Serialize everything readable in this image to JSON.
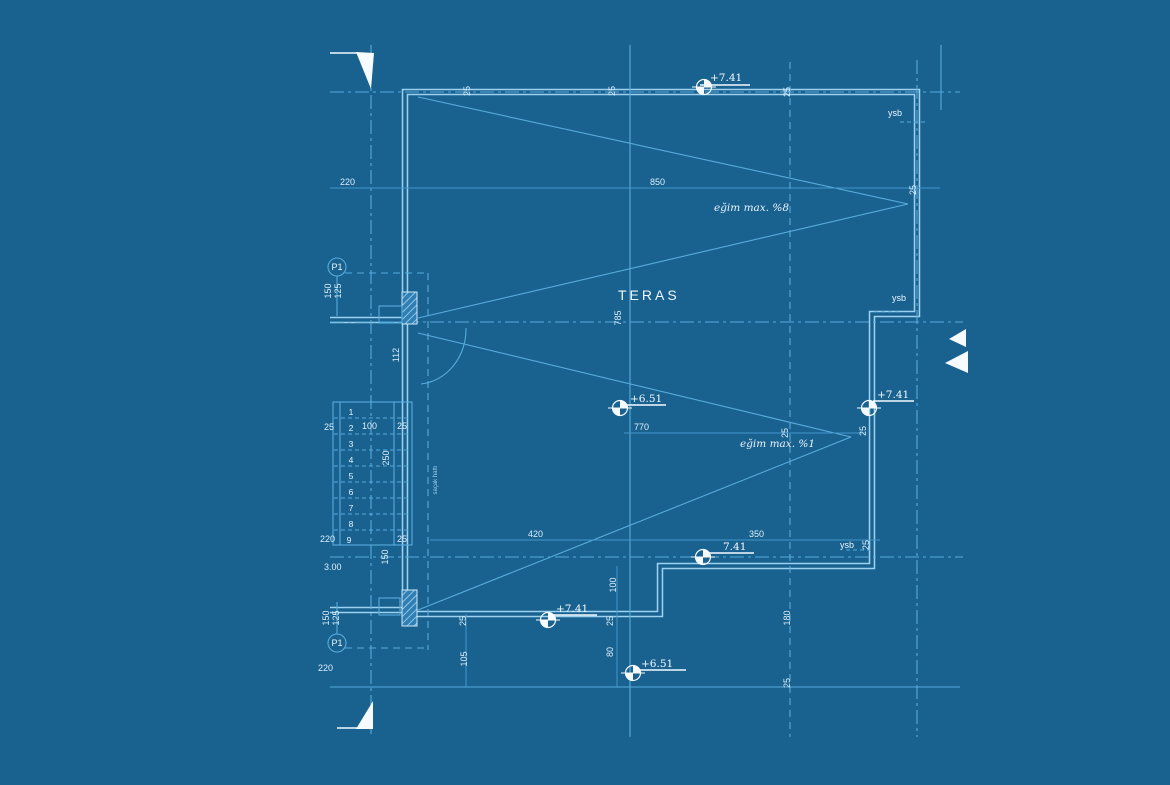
{
  "drawing": {
    "type": "architectural-roof-terrace-plan-blueprint",
    "room_label": "TERAS"
  },
  "colors": {
    "background": "#19618F",
    "line": "#58ACDC",
    "line_bright": "#9CD2F0",
    "text": "#EAF6FF",
    "marker_white": "#F6FBFF"
  },
  "texts": {
    "teras": "TERAS",
    "egim_top": "eğim max. %8",
    "egim_bottom": "eğim max. %1",
    "ysb": "ysb",
    "level_plus741": "+7.41",
    "level_741": "7.41",
    "level_plus651": "+6.51",
    "p1": "P1",
    "eave_note": "saçak hattı",
    "d220": "220",
    "d25": "25",
    "d850": "850",
    "d785": "785",
    "d112": "112",
    "d770": "770",
    "d420": "420",
    "d350": "350",
    "d100": "100",
    "d250": "250",
    "d150": "150",
    "d125": "125",
    "d105": "105",
    "d80": "80",
    "d180": "180",
    "d300": "3.00"
  },
  "stairs": {
    "numbers": [
      "1",
      "2",
      "3",
      "4",
      "5",
      "6",
      "7",
      "8",
      "9"
    ]
  }
}
